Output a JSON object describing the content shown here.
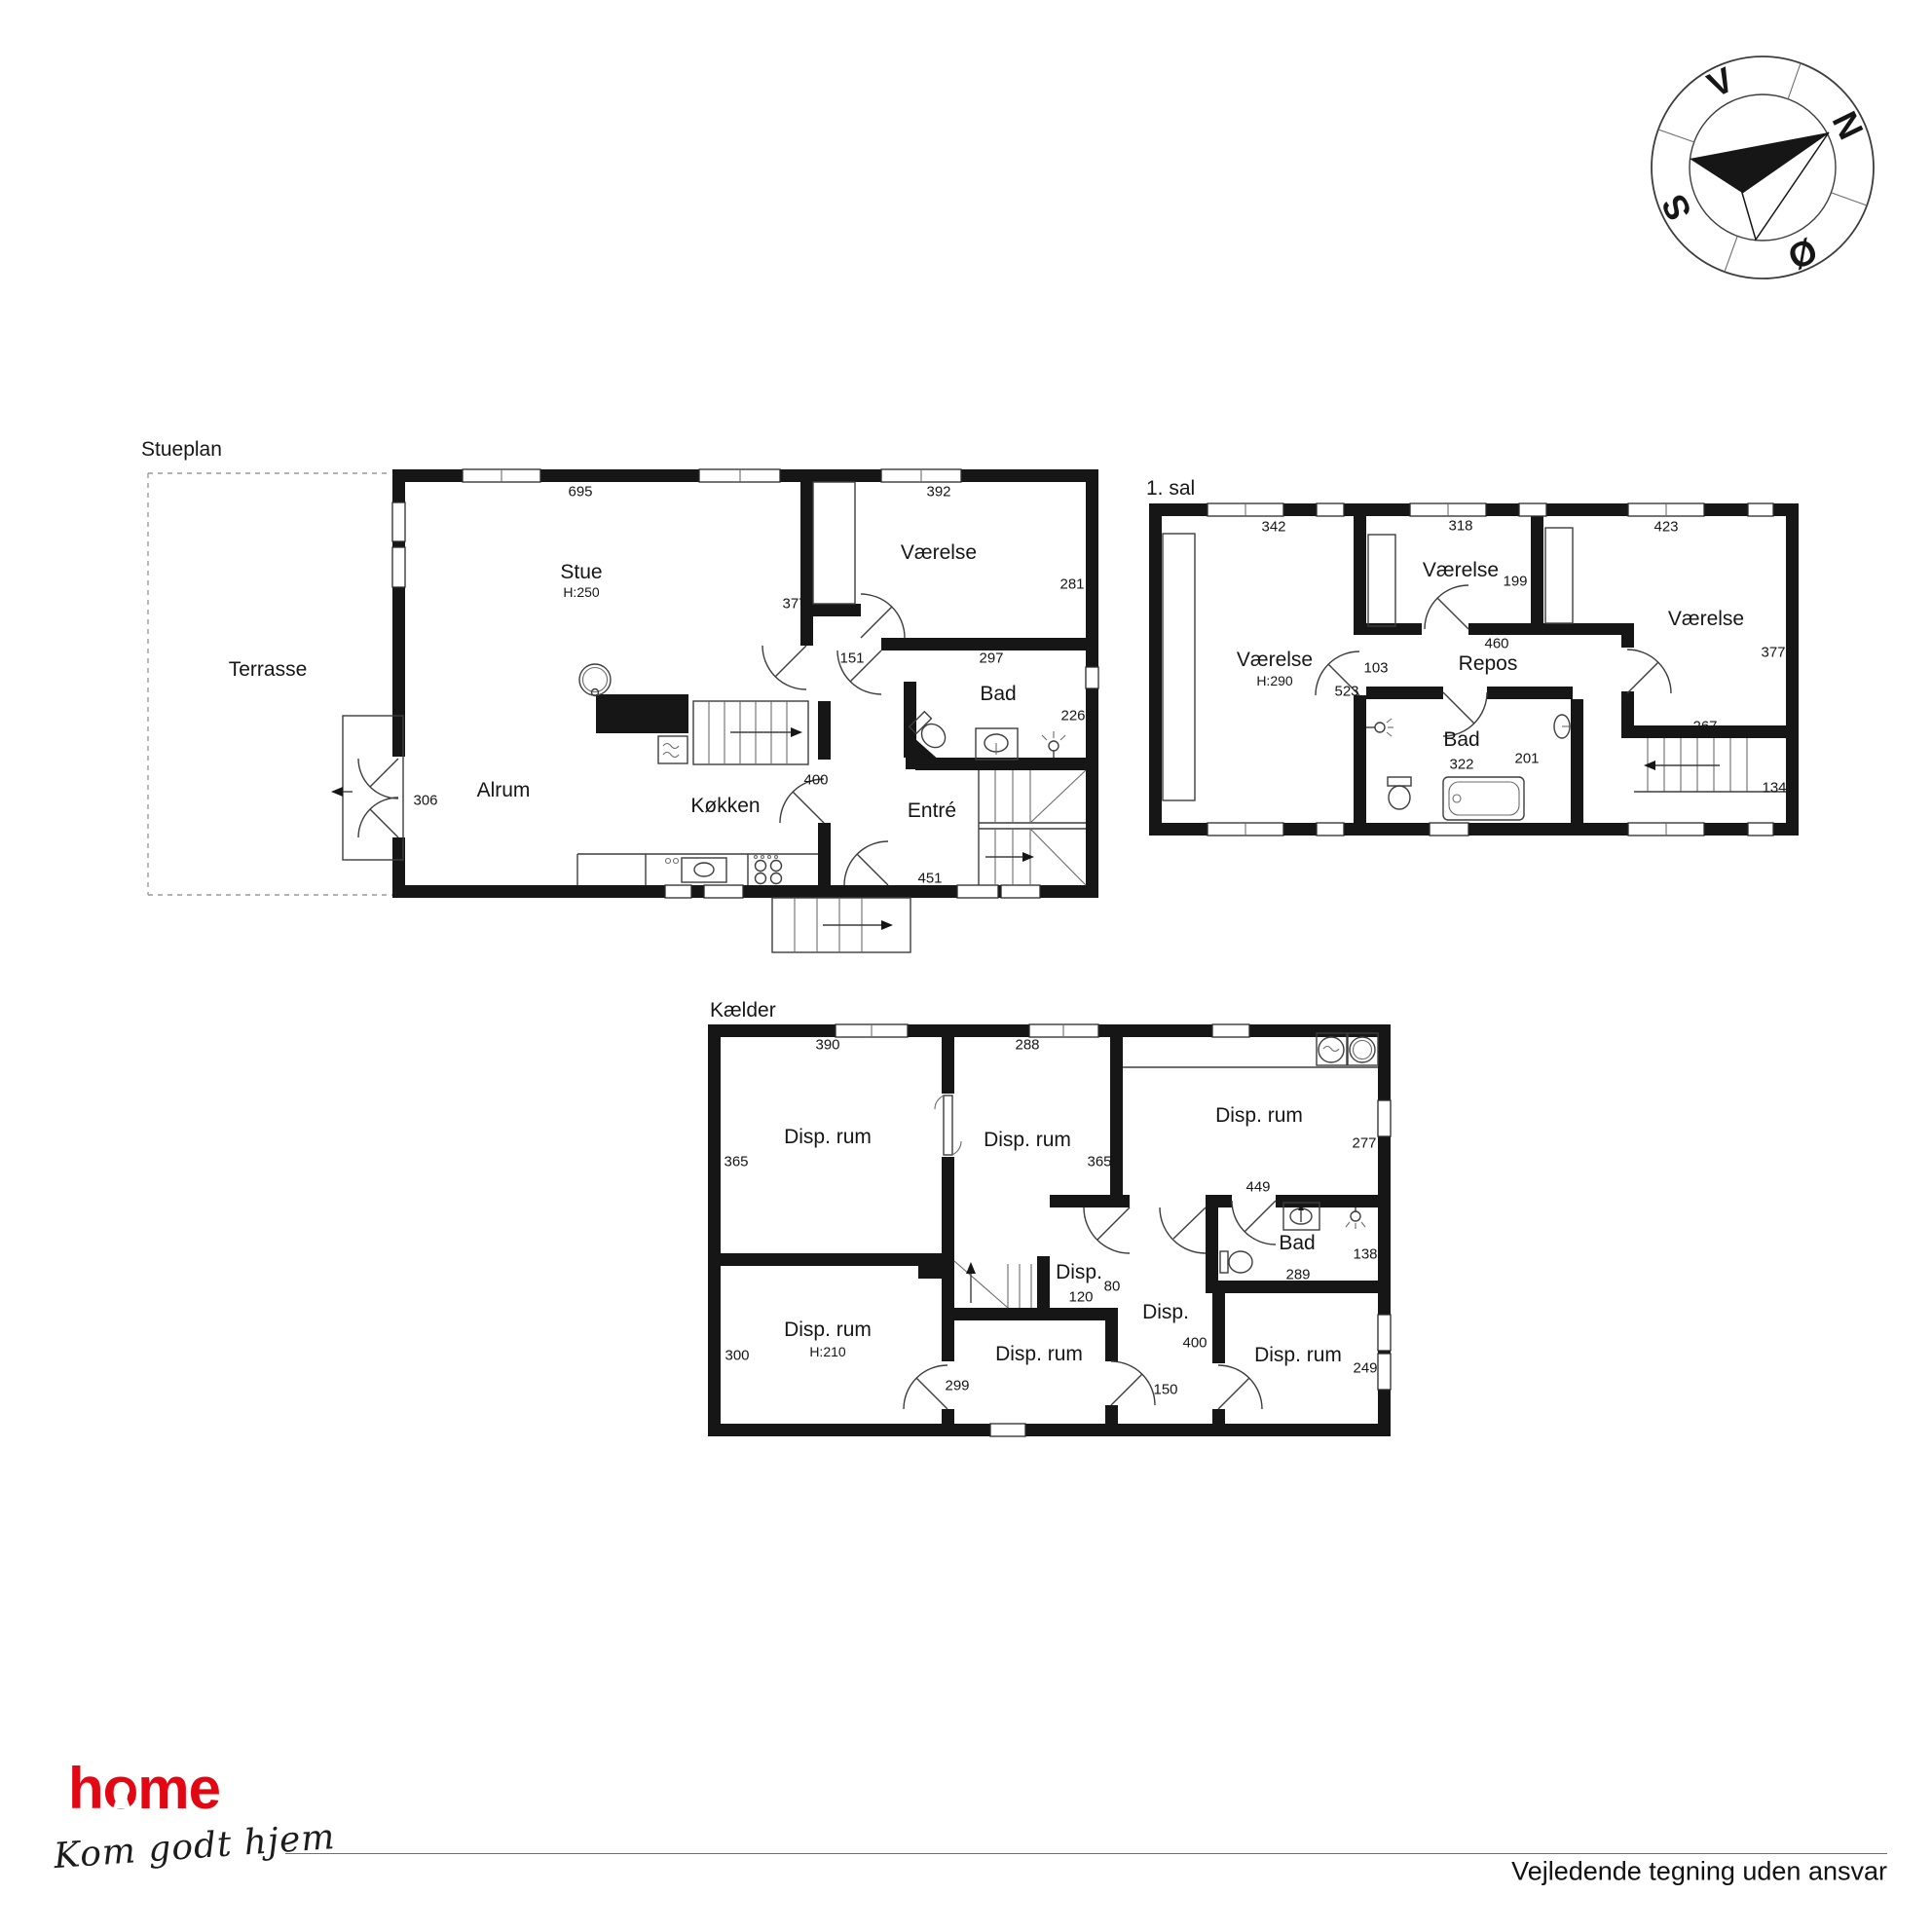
{
  "footer": {
    "disclaimer": "Vejledende tegning uden ansvar"
  },
  "logo": {
    "brand": "home",
    "tagline": "Kom godt hjem",
    "brand_color": "#e30613"
  },
  "compass": {
    "north": "N",
    "east": "Ø",
    "south": "S",
    "west": "V"
  },
  "plans": [
    {
      "title": "Stueplan",
      "rooms": [
        {
          "label": "Terrasse"
        },
        {
          "label": "Stue",
          "height": "H:250"
        },
        {
          "label": "Værelse"
        },
        {
          "label": "Bad"
        },
        {
          "label": "Alrum"
        },
        {
          "label": "Køkken"
        },
        {
          "label": "Entré"
        }
      ],
      "dims": [
        "695",
        "392",
        "377",
        "281",
        "151",
        "297",
        "226",
        "306",
        "400",
        "451"
      ]
    },
    {
      "title": "1. sal",
      "rooms": [
        {
          "label": "Værelse",
          "height": "H:290"
        },
        {
          "label": "Værelse"
        },
        {
          "label": "Værelse"
        },
        {
          "label": "Repos"
        },
        {
          "label": "Bad"
        }
      ],
      "dims": [
        "342",
        "318",
        "423",
        "199",
        "460",
        "103",
        "523",
        "377",
        "267",
        "322",
        "201",
        "134"
      ]
    },
    {
      "title": "Kælder",
      "rooms": [
        {
          "label": "Disp. rum"
        },
        {
          "label": "Disp. rum"
        },
        {
          "label": "Disp. rum"
        },
        {
          "label": "Bad"
        },
        {
          "label": "Disp."
        },
        {
          "label": "Disp. rum",
          "height": "H:210"
        },
        {
          "label": "Disp. rum"
        },
        {
          "label": "Disp."
        },
        {
          "label": "Disp. rum"
        }
      ],
      "dims": [
        "390",
        "288",
        "365",
        "365",
        "277",
        "449",
        "138",
        "289",
        "80",
        "120",
        "300",
        "299",
        "400",
        "150",
        "249"
      ]
    }
  ]
}
